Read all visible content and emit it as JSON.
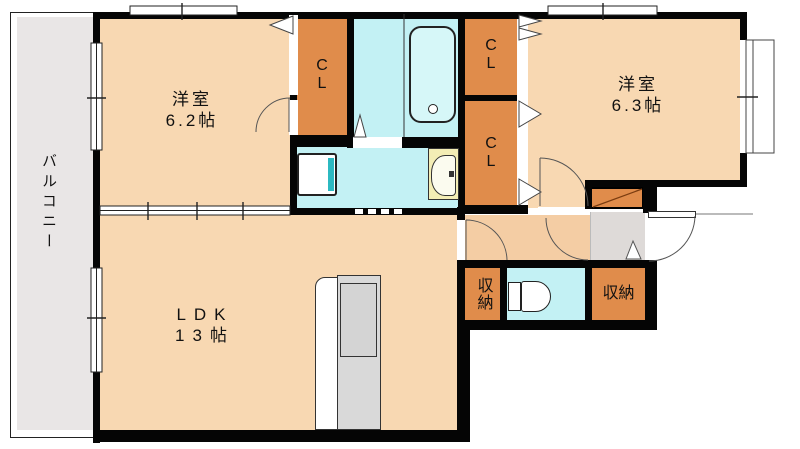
{
  "labels": {
    "balcony": "バルコニー",
    "bedroom1_name": "洋室",
    "bedroom1_size": "6.2帖",
    "bedroom2_name": "洋室",
    "bedroom2_size": "6.3帖",
    "ldk_name": "LDK",
    "ldk_size": "13帖",
    "closet_line1": "C",
    "closet_line2": "L",
    "storage_left": "収納",
    "storage_right": "収納"
  },
  "colors": {
    "floor": "#f8d8b2",
    "hallway_floor": "#f4cda4",
    "closet_orange": "#e08c4b",
    "wet_cyan": "#c3f1f4",
    "tub_cyan": "#d6f7f8",
    "balcony_gray": "#e9e6e6",
    "entry_gray": "#dedad8",
    "counter_gray": "#d9d9d9",
    "basin_yellow": "#f3edb5",
    "washer_teal": "#2cb9c1",
    "wall_black": "#050505"
  }
}
